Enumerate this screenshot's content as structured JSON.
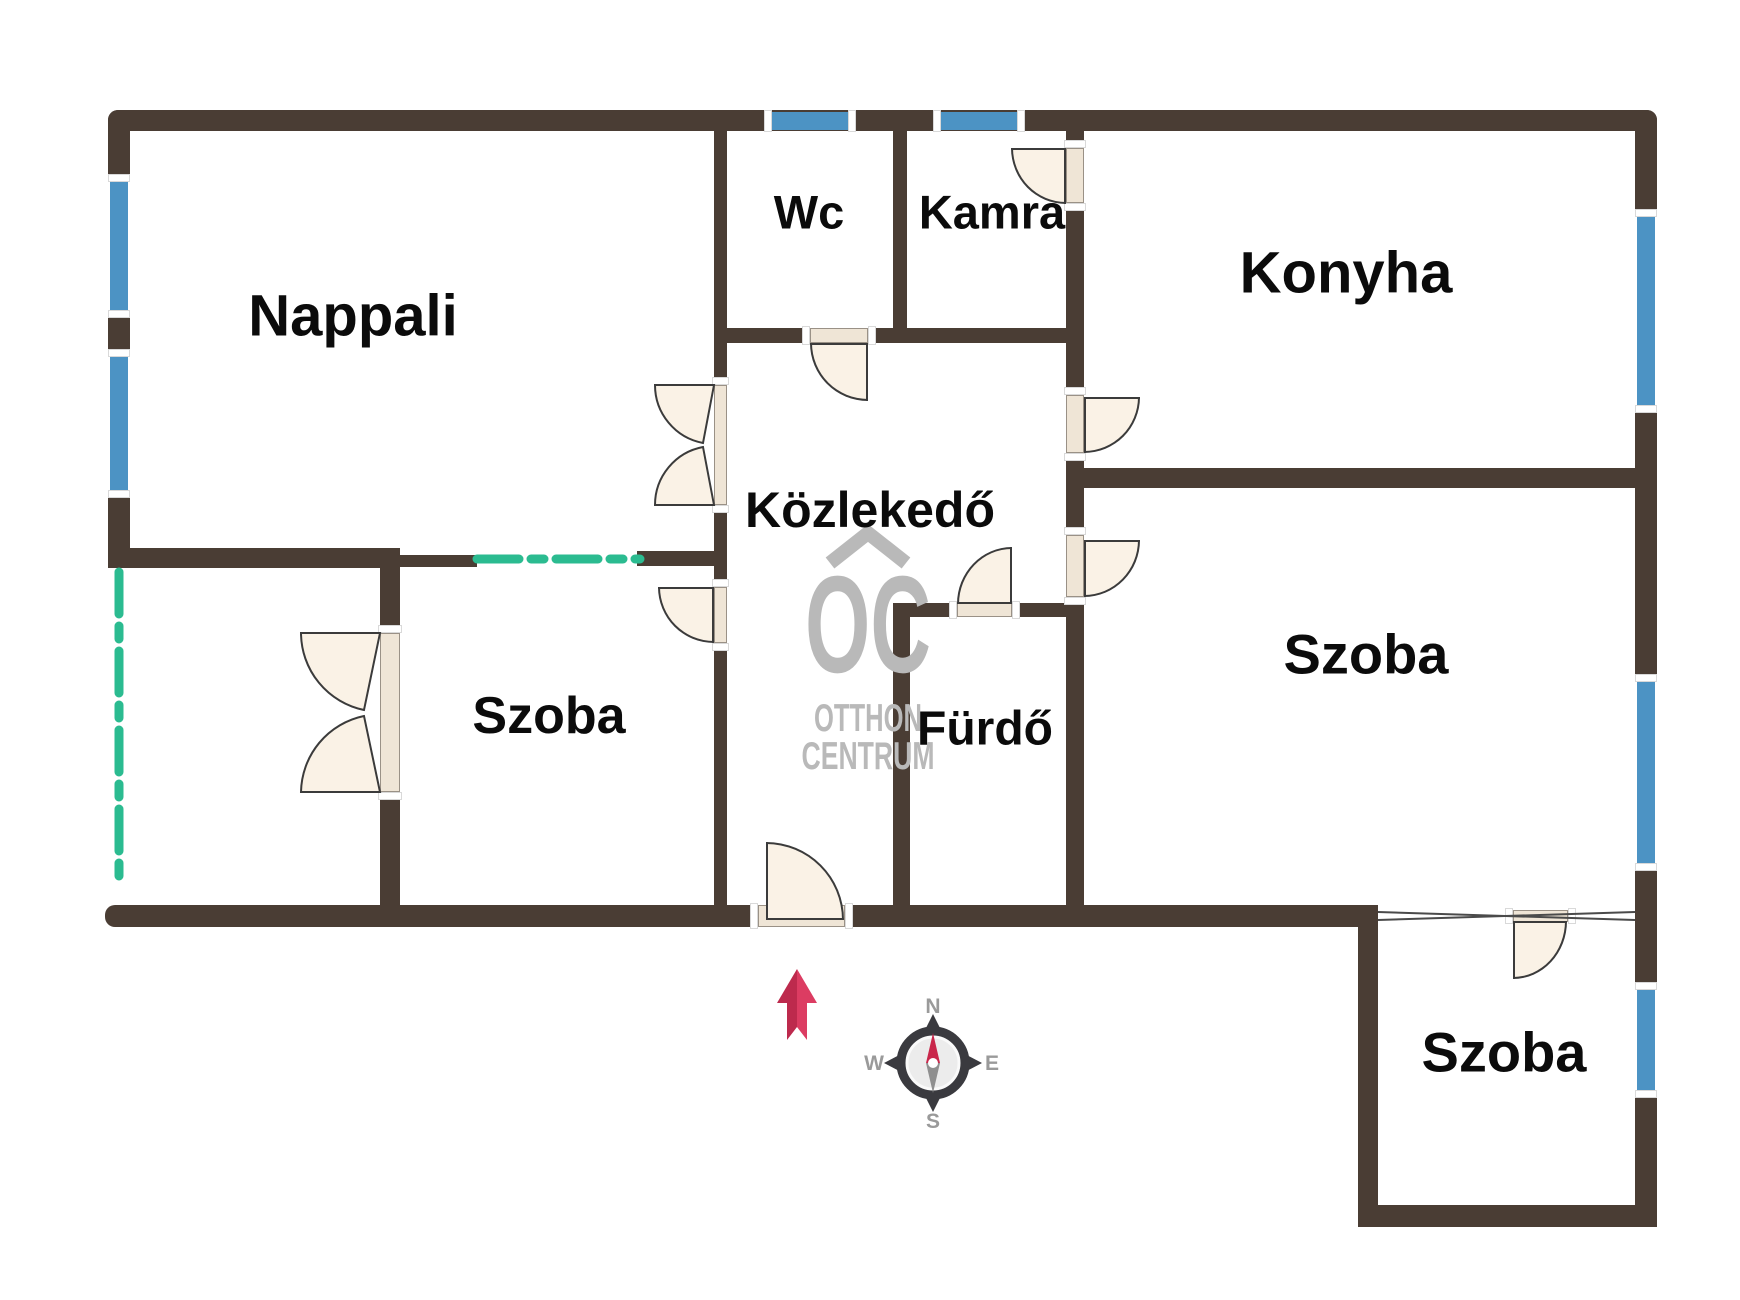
{
  "colors": {
    "wall": "#4a3d34",
    "window": "#4c93c4",
    "door_fill": "#faf2e6",
    "door_stroke": "#3b3b3b",
    "threshold_fill": "#efe5d6",
    "green_dash": "#2bbb90",
    "watermark_gray": "#b9b9b9",
    "arrow_red_dark": "#bd2a4d",
    "arrow_red_light": "#dc3c62",
    "compass_dark": "#3a3a3f"
  },
  "rooms": [
    {
      "label": "Nappali",
      "x": 353,
      "y": 316,
      "size": 58
    },
    {
      "label": "Wc",
      "x": 809,
      "y": 212,
      "size": 47
    },
    {
      "label": "Kamra",
      "x": 992,
      "y": 212,
      "size": 47
    },
    {
      "label": "Konyha",
      "x": 1346,
      "y": 273,
      "size": 58
    },
    {
      "label": "Közlekedő",
      "x": 870,
      "y": 510,
      "size": 50
    },
    {
      "label": "Szoba",
      "x": 549,
      "y": 716,
      "size": 52
    },
    {
      "label": "Fürdő",
      "x": 985,
      "y": 729,
      "size": 48
    },
    {
      "label": "Szoba",
      "x": 1366,
      "y": 654,
      "size": 56
    },
    {
      "label": "Szoba",
      "x": 1504,
      "y": 1052,
      "size": 56
    }
  ],
  "plan": {
    "walls": [
      {
        "x": 108,
        "y": 110,
        "w": 1549,
        "h": 21,
        "r": "10px 10px 0 0"
      },
      {
        "x": 108,
        "y": 110,
        "w": 22,
        "h": 72,
        "r": "10px 0 0 0"
      },
      {
        "x": 108,
        "y": 310,
        "w": 22,
        "h": 47
      },
      {
        "x": 108,
        "y": 490,
        "w": 22,
        "h": 78
      },
      {
        "x": 108,
        "y": 548,
        "w": 292,
        "h": 20,
        "r": "0 0 0 10px"
      },
      {
        "x": 400,
        "y": 555,
        "w": 77,
        "h": 12
      },
      {
        "x": 637,
        "y": 551,
        "w": 77,
        "h": 15
      },
      {
        "x": 714,
        "y": 131,
        "w": 13,
        "h": 254
      },
      {
        "x": 714,
        "y": 505,
        "w": 13,
        "h": 82
      },
      {
        "x": 714,
        "y": 643,
        "w": 13,
        "h": 262
      },
      {
        "x": 893,
        "y": 131,
        "w": 14,
        "h": 212
      },
      {
        "x": 727,
        "y": 328,
        "w": 83,
        "h": 15
      },
      {
        "x": 868,
        "y": 328,
        "w": 198,
        "h": 15
      },
      {
        "x": 1066,
        "y": 131,
        "w": 18,
        "h": 17
      },
      {
        "x": 1066,
        "y": 203,
        "w": 18,
        "h": 192
      },
      {
        "x": 1066,
        "y": 453,
        "w": 18,
        "h": 82
      },
      {
        "x": 1066,
        "y": 597,
        "w": 18,
        "h": 308
      },
      {
        "x": 1084,
        "y": 468,
        "w": 573,
        "h": 20
      },
      {
        "x": 893,
        "y": 603,
        "w": 64,
        "h": 14
      },
      {
        "x": 1012,
        "y": 603,
        "w": 61,
        "h": 14
      },
      {
        "x": 893,
        "y": 617,
        "w": 17,
        "h": 288
      },
      {
        "x": 105,
        "y": 905,
        "w": 653,
        "h": 22,
        "r": "10px 0 0 10px"
      },
      {
        "x": 845,
        "y": 905,
        "w": 533,
        "h": 22
      },
      {
        "x": 380,
        "y": 568,
        "w": 20,
        "h": 65
      },
      {
        "x": 380,
        "y": 792,
        "w": 20,
        "h": 113
      },
      {
        "x": 1358,
        "y": 905,
        "w": 20,
        "h": 322
      },
      {
        "x": 1358,
        "y": 1205,
        "w": 299,
        "h": 22,
        "r": "0 0 10px 10px"
      },
      {
        "x": 1635,
        "y": 110,
        "w": 22,
        "h": 107,
        "r": "0 10px 0 0"
      },
      {
        "x": 1635,
        "y": 405,
        "w": 22,
        "h": 277
      },
      {
        "x": 1635,
        "y": 863,
        "w": 22,
        "h": 127
      },
      {
        "x": 1635,
        "y": 1090,
        "w": 22,
        "h": 137
      }
    ],
    "windows": [
      {
        "x": 772,
        "y": 112,
        "w": 76,
        "h": 18,
        "o": "h"
      },
      {
        "x": 941,
        "y": 112,
        "w": 76,
        "h": 18,
        "o": "h"
      },
      {
        "x": 110,
        "y": 182,
        "w": 18,
        "h": 128,
        "o": "v"
      },
      {
        "x": 110,
        "y": 357,
        "w": 18,
        "h": 133,
        "o": "v"
      },
      {
        "x": 1637,
        "y": 217,
        "w": 18,
        "h": 188,
        "o": "v"
      },
      {
        "x": 1637,
        "y": 682,
        "w": 18,
        "h": 181,
        "o": "v"
      },
      {
        "x": 1637,
        "y": 990,
        "w": 18,
        "h": 100,
        "o": "v"
      }
    ],
    "thresholds": [
      {
        "x": 810,
        "y": 328,
        "w": 58,
        "h": 15,
        "o": "h"
      },
      {
        "x": 1066,
        "y": 148,
        "w": 18,
        "h": 55,
        "o": "v"
      },
      {
        "x": 1066,
        "y": 395,
        "w": 18,
        "h": 58,
        "o": "v"
      },
      {
        "x": 1066,
        "y": 535,
        "w": 18,
        "h": 62,
        "o": "v"
      },
      {
        "x": 957,
        "y": 603,
        "w": 55,
        "h": 14,
        "o": "h"
      },
      {
        "x": 758,
        "y": 905,
        "w": 87,
        "h": 22,
        "o": "h"
      },
      {
        "x": 714,
        "y": 587,
        "w": 13,
        "h": 56,
        "o": "v"
      },
      {
        "x": 1513,
        "y": 910,
        "w": 55,
        "h": 12,
        "o": "h"
      },
      {
        "x": 714,
        "y": 385,
        "w": 13,
        "h": 120,
        "o": "v"
      },
      {
        "x": 380,
        "y": 633,
        "w": 20,
        "h": 159,
        "o": "v"
      }
    ],
    "doors": [
      {
        "name": "door-wc",
        "x": 810,
        "y": 343,
        "w": 58,
        "h": 58,
        "corner": "bl"
      },
      {
        "name": "door-kamra",
        "x": 1011,
        "y": 148,
        "w": 55,
        "h": 56,
        "corner": "bl"
      },
      {
        "name": "door-konyha",
        "x": 1084,
        "y": 397,
        "w": 56,
        "h": 56,
        "corner": "br"
      },
      {
        "name": "door-szoba-right",
        "x": 1084,
        "y": 540,
        "w": 56,
        "h": 57,
        "corner": "br"
      },
      {
        "name": "door-furdo",
        "x": 957,
        "y": 547,
        "w": 55,
        "h": 57,
        "corner": "tl"
      },
      {
        "name": "door-entrance",
        "x": 766,
        "y": 842,
        "w": 78,
        "h": 78,
        "corner": "tr"
      },
      {
        "name": "door-szoba-left",
        "x": 658,
        "y": 587,
        "w": 56,
        "h": 56,
        "corner": "bl"
      },
      {
        "name": "door-szoba-bottom",
        "x": 1513,
        "y": 921,
        "w": 54,
        "h": 58,
        "corner": "br"
      }
    ],
    "butterfly_paths": [
      "M714,385 L655,385 A59,59 0 0 0 703,443 Z",
      "M714,505 L655,505 A59,59 0 0 1 703,447 Z",
      "M380,633 L301,633 A79,79 0 0 0 364,710 Z",
      "M380,792 L301,792 A79,79 0 0 1 364,716 Z"
    ],
    "green_lines": [
      {
        "x1": 477,
        "y1": 559,
        "x2": 640,
        "y2": 559
      },
      {
        "x1": 119,
        "y1": 572,
        "x2": 119,
        "y2": 888
      }
    ],
    "thin_wall_lines": [
      {
        "x1": 1378,
        "y1": 912,
        "x2": 1635,
        "y2": 920
      },
      {
        "x1": 1378,
        "y1": 920,
        "x2": 1635,
        "y2": 912
      }
    ]
  },
  "watermark": {
    "line0": "OC",
    "line1": "OTTHON",
    "line2": "CENTRUM"
  },
  "compass": {
    "n": "N",
    "e": "E",
    "s": "S",
    "w": "W"
  }
}
